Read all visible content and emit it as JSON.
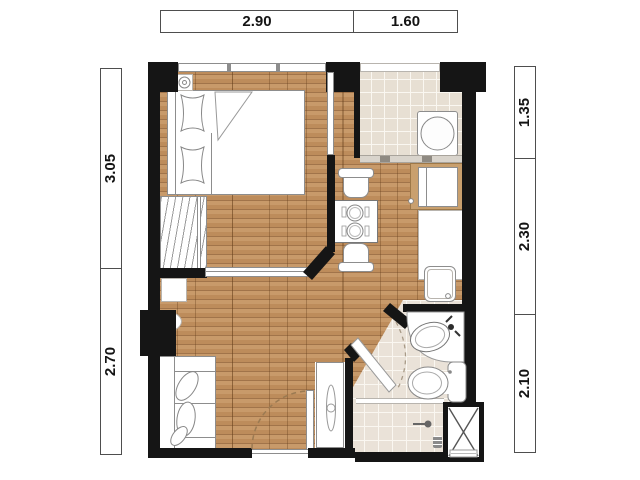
{
  "plan": {
    "dimensions_top": [
      {
        "value": "2.90"
      },
      {
        "value": "1.60"
      }
    ],
    "dimensions_left": [
      {
        "value": "3.05"
      },
      {
        "value": "2.70"
      }
    ],
    "dimensions_right": [
      {
        "value": "1.35"
      },
      {
        "value": "2.30"
      },
      {
        "value": "2.10"
      }
    ]
  },
  "theme": {
    "wall": "#151515",
    "wood-row1": "#c89a6a",
    "wood-row2": "#bd8c5b",
    "wood-line": "#a1744a",
    "tile": "#e7dfd3",
    "bath-tile": "#eae2d8",
    "grout": "#faf7f1",
    "tan": "#c9a06e",
    "stroke": "#8d8d8d",
    "swing": "#9b7a52",
    "bath-swing": "#a89a87",
    "dim-border": "#4e4e4e"
  }
}
